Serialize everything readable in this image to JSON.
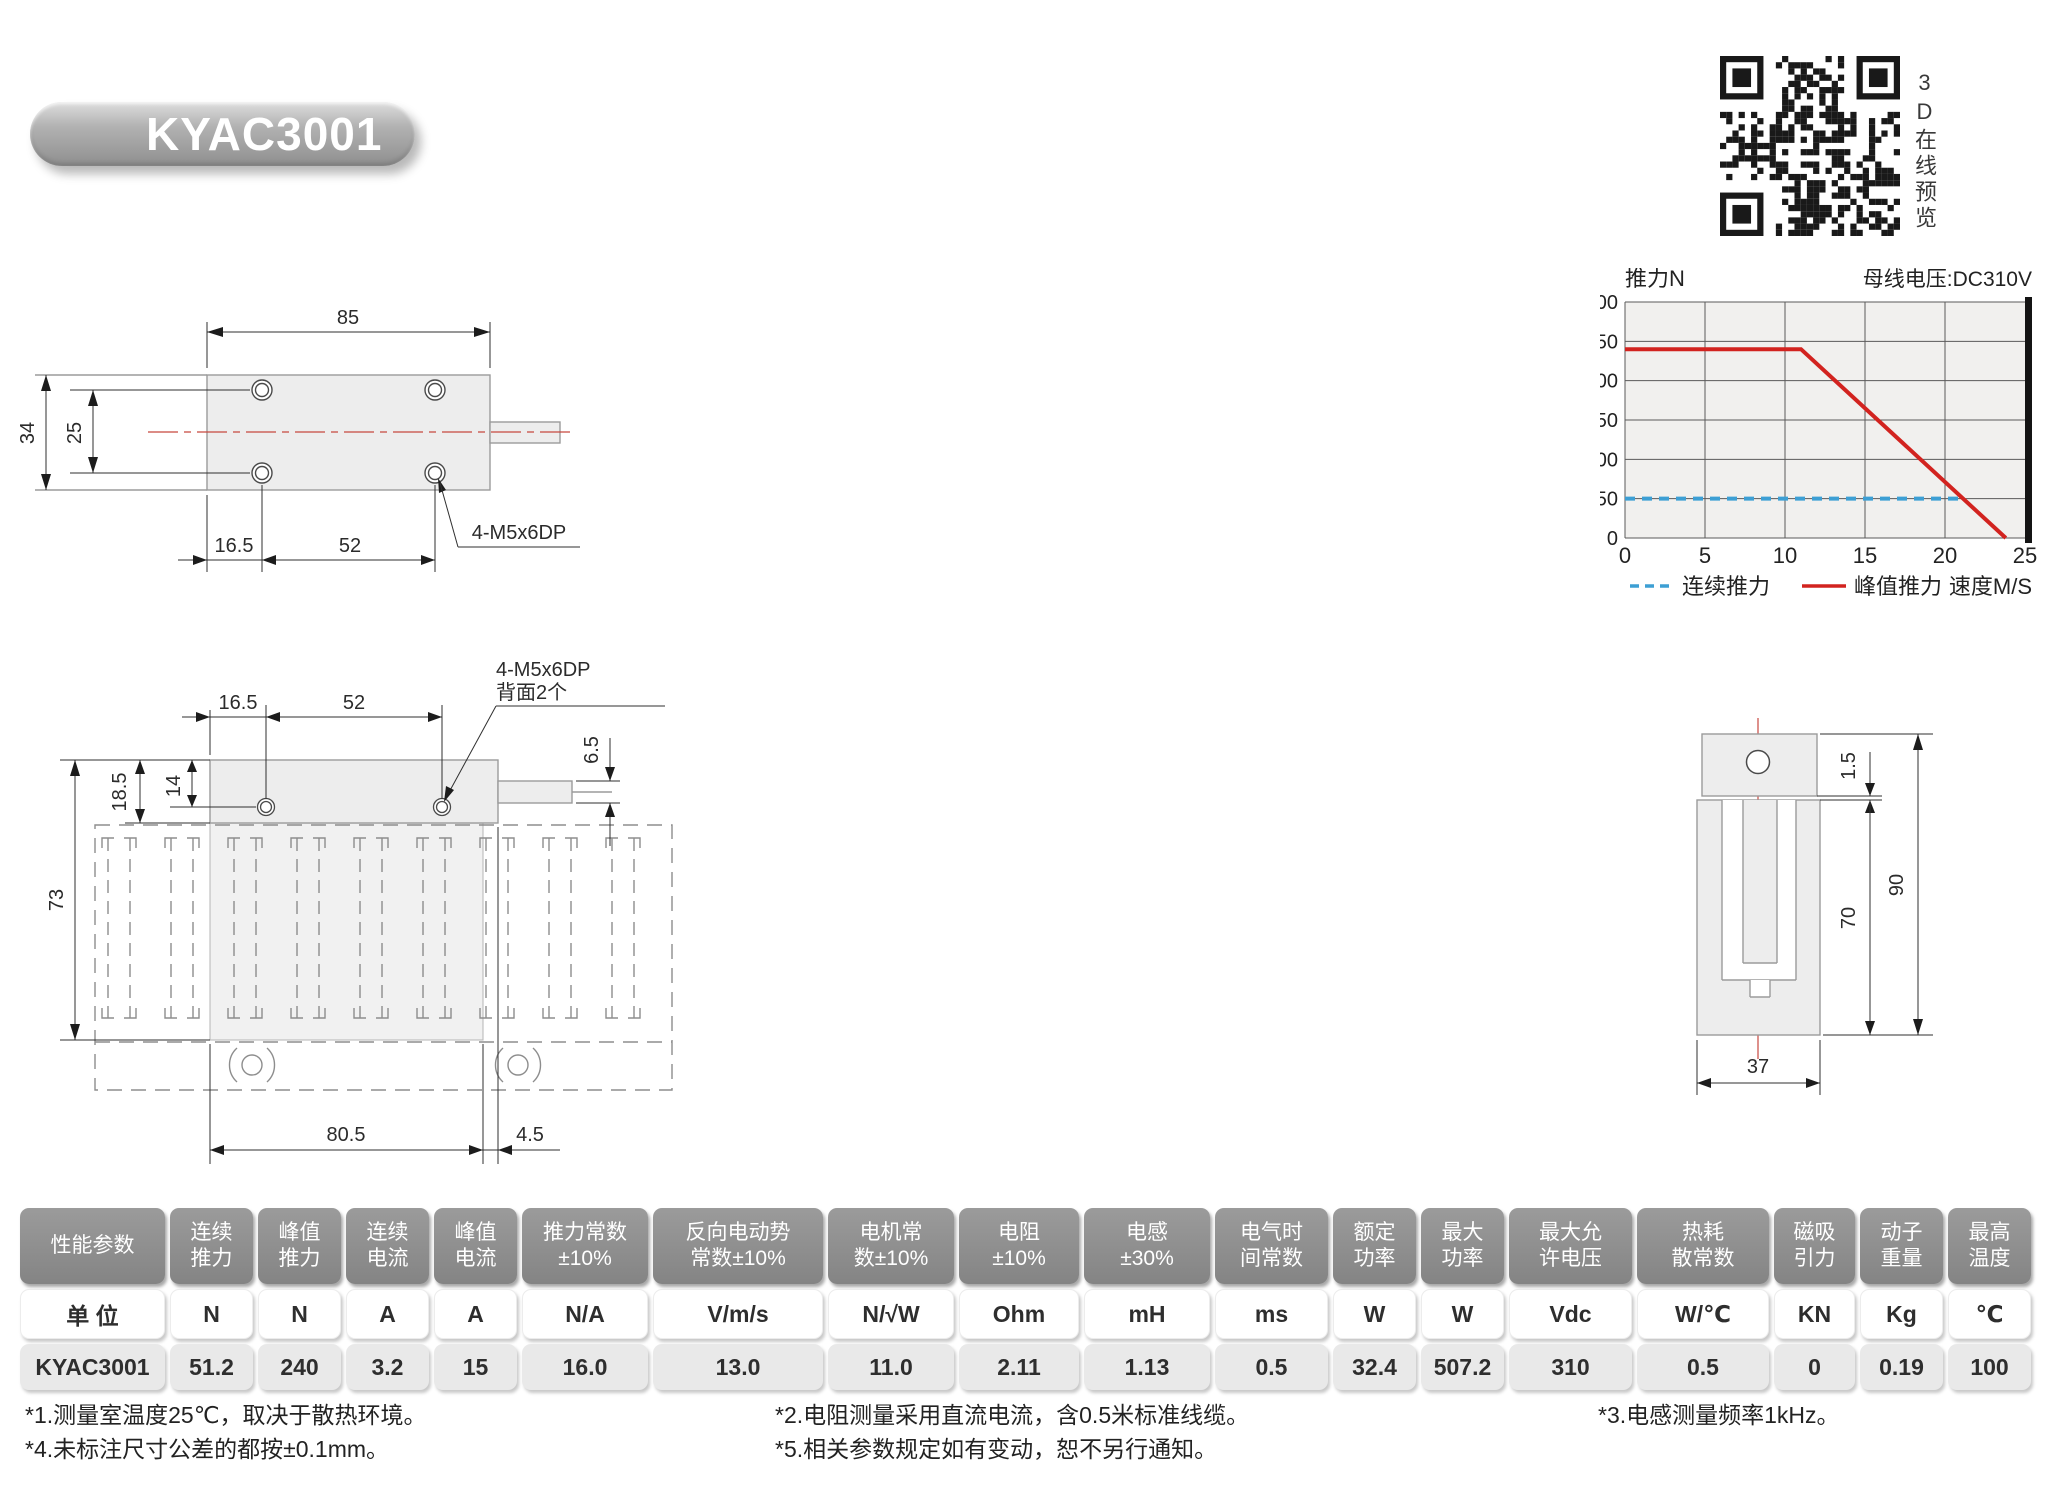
{
  "page": {
    "title_badge": "KYAC3001"
  },
  "qr": {
    "icon": "qr-code-icon",
    "label_vertical": "3D在线预览"
  },
  "chart_data": {
    "type": "line",
    "title_left": "推力N",
    "title_right": "母线电压:DC310V",
    "xlabel": "速度M/S",
    "xlim": [
      0,
      25
    ],
    "ylim": [
      0,
      300
    ],
    "x_ticks": [
      0,
      5,
      10,
      15,
      20,
      25
    ],
    "y_ticks": [
      0,
      50,
      100,
      150,
      200,
      250,
      300
    ],
    "grid": true,
    "legend_position": "bottom",
    "series": [
      {
        "name": "连续推力",
        "style": "dashed",
        "color": "#3d9fd4",
        "points": [
          [
            0,
            50
          ],
          [
            21,
            50
          ]
        ]
      },
      {
        "name": "峰值推力",
        "style": "solid",
        "color": "#d2231f",
        "points": [
          [
            0,
            240
          ],
          [
            11,
            240
          ],
          [
            23.8,
            0
          ]
        ]
      }
    ]
  },
  "drawings": {
    "top_view": {
      "width": "85",
      "height": "34",
      "hole_pitch_v": "25",
      "left_offset": "16.5",
      "hole_span": "52",
      "thread": "4-M5x6DP"
    },
    "front_view": {
      "left_offset": "16.5",
      "hole_span": "52",
      "thread_line1": "4-M5x6DP",
      "thread_line2": "背面2个",
      "shaft_offset": "6.5",
      "body_h": "18.5",
      "hole_top": "14",
      "total_h": "73",
      "body_w": "80.5",
      "shaft_gap": "4.5"
    },
    "side_view": {
      "plate_t": "1.5",
      "body_h": "70",
      "total_h": "90",
      "width": "37"
    }
  },
  "table": {
    "columns": [
      {
        "label": "性能参数",
        "unit": "单 位",
        "value": "KYAC3001"
      },
      {
        "label": "连续\n推力",
        "unit": "N",
        "value": "51.2"
      },
      {
        "label": "峰值\n推力",
        "unit": "N",
        "value": "240"
      },
      {
        "label": "连续\n电流",
        "unit": "A",
        "value": "3.2"
      },
      {
        "label": "峰值\n电流",
        "unit": "A",
        "value": "15"
      },
      {
        "label": "推力常数\n±10%",
        "unit": "N/A",
        "value": "16.0"
      },
      {
        "label": "反向电动势\n常数±10%",
        "unit": "V/m/s",
        "value": "13.0"
      },
      {
        "label": "电机常\n数±10%",
        "unit": "N/√W",
        "value": "11.0"
      },
      {
        "label": "电阻\n±10%",
        "unit": "Ohm",
        "value": "2.11"
      },
      {
        "label": "电感\n±30%",
        "unit": "mH",
        "value": "1.13"
      },
      {
        "label": "电气时\n间常数",
        "unit": "ms",
        "value": "0.5"
      },
      {
        "label": "额定\n功率",
        "unit": "W",
        "value": "32.4"
      },
      {
        "label": "最大\n功率",
        "unit": "W",
        "value": "507.2"
      },
      {
        "label": "最大允\n许电压",
        "unit": "Vdc",
        "value": "310"
      },
      {
        "label": "热耗\n散常数",
        "unit": "W/℃",
        "value": "0.5"
      },
      {
        "label": "磁吸\n引力",
        "unit": "KN",
        "value": "0"
      },
      {
        "label": "动子\n重量",
        "unit": "Kg",
        "value": "0.19"
      },
      {
        "label": "最高\n温度",
        "unit": "℃",
        "value": "100"
      }
    ]
  },
  "notes": [
    "*1.测量室温度25℃，取决于散热环境。",
    "*4.未标注尺寸公差的都按±0.1mm。",
    "*2.电阻测量采用直流电流，含0.5米标准线缆。",
    "*5.相关参数规定如有变动，恕不另行通知。",
    "*3.电感测量频率1kHz。"
  ]
}
